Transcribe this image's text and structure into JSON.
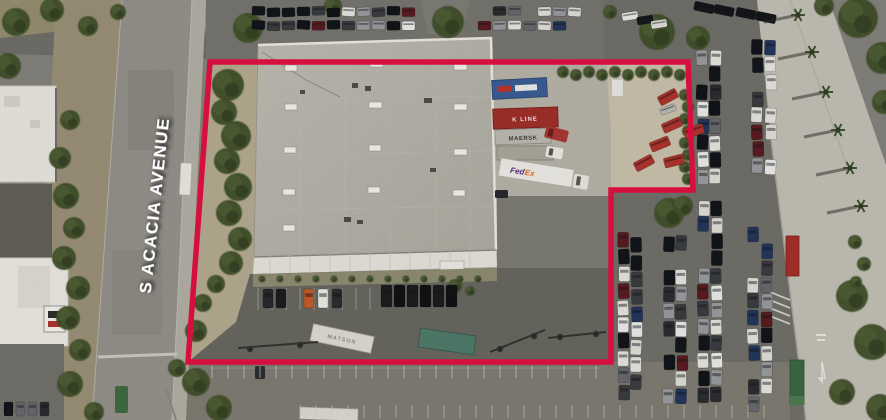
{
  "street_label": "S ACACIA AVENUE",
  "boundary": {
    "color": "#d60f3e",
    "width": 5.5
  },
  "label_style": {
    "color": "#ffffff"
  },
  "containers": {
    "kline_red": "K LINE",
    "maersk": "MAERSK",
    "fedex_fed": "Fed",
    "fedex_ex": "Ex",
    "matson": "MATSON"
  }
}
